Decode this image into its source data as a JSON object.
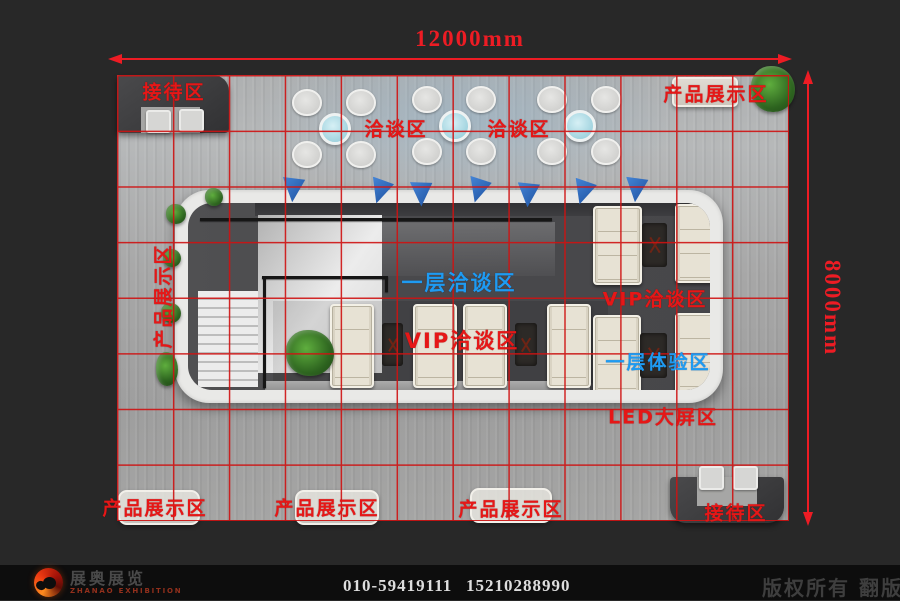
{
  "scene": {
    "type": "exhibition-booth-floor-plan-top-view"
  },
  "dimensions": {
    "width": "12000mm",
    "depth": "8000mm"
  },
  "areas": {
    "reception_top": "接待区",
    "reception_bottom": "接待区",
    "product_display_top": "产品展示区",
    "product_display_left": "产品展示区",
    "product_display_bottom_1": "产品展示区",
    "product_display_bottom_2": "产品展示区",
    "product_display_bottom_3": "产品展示区",
    "negotiation_top_1": "洽谈区",
    "negotiation_top_2": "洽谈区",
    "first_floor_negotiation": "一层洽谈区",
    "vip_negotiation_center": "VIP洽谈区",
    "vip_negotiation_right": "VIP洽谈区",
    "first_floor_experience": "一层体验区",
    "led_screen_area": "LED大屏区"
  },
  "footer": {
    "logo_cn": "展奥展览",
    "logo_en": "ZHANAO EXHIBITION",
    "phone_primary": "010-59419111",
    "phone_secondary": "15210288990",
    "copyright": "版权所有 翻版必究"
  },
  "colors": {
    "bg": "#282828",
    "footer-bg": "#0d0d0d",
    "grid-red": "#cf1212",
    "label-red": "#e61717",
    "label-blue": "#1e9bf2",
    "dim-red": "#ed1c24",
    "structure-white": "#e9e9e7",
    "interior-gray": "#4a4a4c",
    "sofa-cream": "#e7e2d4",
    "flag-blue": "#2f6fc4"
  }
}
